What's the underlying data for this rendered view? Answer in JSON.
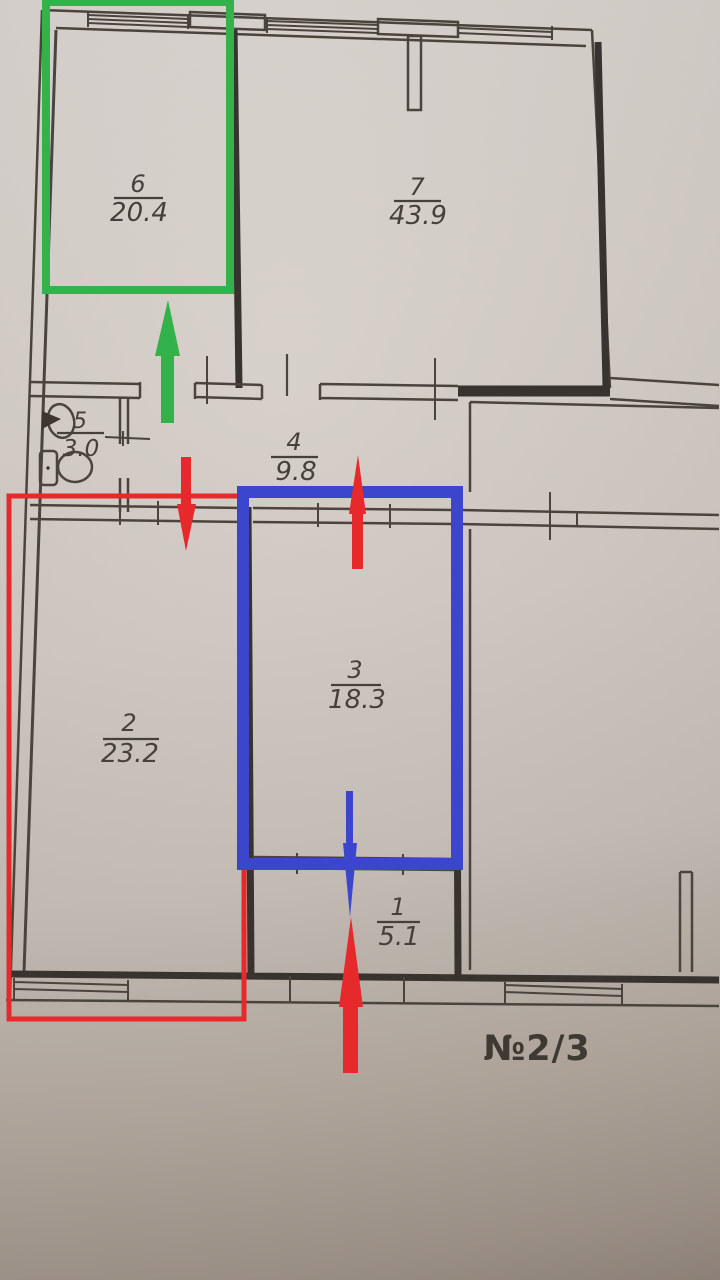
{
  "document": {
    "kind": "apartment floor plan photo",
    "unit_label": "№2/3"
  },
  "rooms": [
    {
      "number": "1",
      "area": "5.1"
    },
    {
      "number": "2",
      "area": "23.2"
    },
    {
      "number": "3",
      "area": "18.3"
    },
    {
      "number": "4",
      "area": "9.8"
    },
    {
      "number": "5",
      "area": "3.0"
    },
    {
      "number": "6",
      "area": "20.4"
    },
    {
      "number": "7",
      "area": "43.9"
    }
  ],
  "fixtures": {
    "sink": "sink",
    "toilet": "toilet"
  },
  "colors": {
    "green": "#33b24b",
    "red": "#e62a2c",
    "blue": "#3c46cc",
    "line": "#4b443d"
  },
  "annotations": {
    "green_box": {
      "room": "6",
      "color": "#33b24b"
    },
    "red_box": {
      "room": "2",
      "color": "#e62a2c"
    },
    "blue_box": {
      "room": "3",
      "color": "#3c46cc"
    },
    "arrows": [
      {
        "name": "green-arrow-up",
        "direction": "up",
        "color": "#33b24b"
      },
      {
        "name": "red-arrow-down",
        "direction": "down",
        "color": "#e62a2c"
      },
      {
        "name": "red-arrow-up-middle",
        "direction": "up",
        "color": "#e62a2c"
      },
      {
        "name": "blue-arrow-down",
        "direction": "down",
        "color": "#3c46cc"
      },
      {
        "name": "red-arrow-up-bottom",
        "direction": "up",
        "color": "#e62a2c"
      }
    ]
  }
}
